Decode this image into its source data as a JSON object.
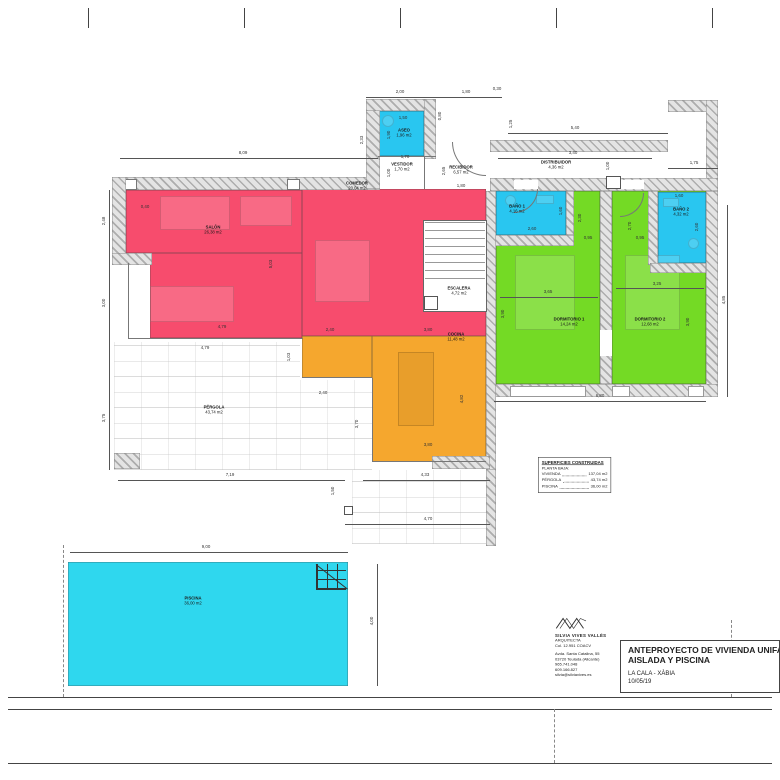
{
  "sheet": {
    "project": {
      "title_line1": "ANTEPROYECTO DE VIVIENDA UNIFAMILIAR",
      "title_line2": "AISLADA Y PISCINA",
      "location": "LA CALA - XÀBIA",
      "date": "10/05/19"
    },
    "architect": {
      "name": "SILVIA VIVES VALLÉS",
      "role": "ARQUITECTA",
      "license": "Col. 12.951 COACV",
      "address1": "Avda. Santa Catalina, 55",
      "address2": "03720 Teulada (Alicante)",
      "phone1": "965.741.048",
      "phone2": "609.166.827",
      "email": "silvia@silviavives.es"
    }
  },
  "legend": {
    "title": "SUPERFICIES CONSTRUIDAS",
    "subtitle": "PLANTA BAJA:",
    "rows": [
      {
        "label": "VIVIENDA",
        "value": "137,04 m2"
      },
      {
        "label": "PÉRGOLA",
        "value": "43,74 m2"
      },
      {
        "label": "PISCINA",
        "value": "36,00 m2"
      }
    ]
  },
  "rooms": [
    {
      "id": "salon",
      "name": "SALÓN",
      "area": "26,38 m2",
      "x": 213,
      "y": 230
    },
    {
      "id": "comedor",
      "name": "COMEDOR",
      "area": "20,04 m2",
      "x": 357,
      "y": 186
    },
    {
      "id": "cocina",
      "name": "COCINA",
      "area": "11,48 m2",
      "x": 456,
      "y": 337
    },
    {
      "id": "escalera",
      "name": "ESCALERA",
      "area": "4,72 m2",
      "x": 459,
      "y": 291
    },
    {
      "id": "recibidor",
      "name": "RECIBIDOR",
      "area": "6,57 m2",
      "x": 461,
      "y": 170
    },
    {
      "id": "vestidor",
      "name": "VESTIDOR",
      "area": "1,70 m2",
      "x": 402,
      "y": 167
    },
    {
      "id": "distribuidor",
      "name": "DISTRIBUIDOR",
      "area": "4,36 m2",
      "x": 556,
      "y": 165
    },
    {
      "id": "aseo",
      "name": "ASEO",
      "area": "1,96 m2",
      "x": 404,
      "y": 133
    },
    {
      "id": "bano1",
      "name": "BAÑO 1",
      "area": "4,16 m2",
      "x": 517,
      "y": 209
    },
    {
      "id": "bano2",
      "name": "BAÑO 2",
      "area": "4,32 m2",
      "x": 681,
      "y": 212
    },
    {
      "id": "dormitorio1",
      "name": "DORMITORIO 1",
      "area": "14,24 m2",
      "x": 569,
      "y": 322
    },
    {
      "id": "dormitorio2",
      "name": "DORMITORIO 2",
      "area": "12,68 m2",
      "x": 650,
      "y": 322
    },
    {
      "id": "pergola",
      "name": "PÉRGOLA",
      "area": "43,74 m2",
      "x": 214,
      "y": 410
    },
    {
      "id": "piscina",
      "name": "PISCINA",
      "area": "36,00 m2",
      "x": 193,
      "y": 601
    }
  ],
  "dimensions": [
    {
      "t": "8,09",
      "x": 243,
      "y": 153
    },
    {
      "t": "2,00",
      "x": 400,
      "y": 92
    },
    {
      "t": "1,80",
      "x": 466,
      "y": 92
    },
    {
      "t": "0,30",
      "x": 497,
      "y": 89
    },
    {
      "t": "5,40",
      "x": 575,
      "y": 128
    },
    {
      "t": "3,40",
      "x": 573,
      "y": 153
    },
    {
      "t": "1,75",
      "x": 694,
      "y": 163
    },
    {
      "t": "1,00",
      "x": 608,
      "y": 166,
      "v": 1
    },
    {
      "t": "1,25",
      "x": 511,
      "y": 124,
      "v": 1
    },
    {
      "t": "2,33",
      "x": 362,
      "y": 140,
      "v": 1
    },
    {
      "t": "1,90",
      "x": 389,
      "y": 135,
      "v": 1
    },
    {
      "t": "1,50",
      "x": 403,
      "y": 118
    },
    {
      "t": "0,80",
      "x": 440,
      "y": 116,
      "v": 1
    },
    {
      "t": "1,70",
      "x": 405,
      "y": 157
    },
    {
      "t": "1,00",
      "x": 389,
      "y": 173,
      "v": 1
    },
    {
      "t": "2,65",
      "x": 444,
      "y": 171,
      "v": 1
    },
    {
      "t": "1,80",
      "x": 461,
      "y": 186
    },
    {
      "t": "2,48",
      "x": 104,
      "y": 221,
      "v": 1
    },
    {
      "t": "3,00",
      "x": 104,
      "y": 303,
      "v": 1
    },
    {
      "t": "3,75",
      "x": 104,
      "y": 418,
      "v": 1
    },
    {
      "t": "0,40",
      "x": 145,
      "y": 207
    },
    {
      "t": "5,03",
      "x": 271,
      "y": 264,
      "v": 1
    },
    {
      "t": "4,79",
      "x": 222,
      "y": 327
    },
    {
      "t": "4,79",
      "x": 205,
      "y": 348
    },
    {
      "t": "2,40",
      "x": 330,
      "y": 330
    },
    {
      "t": "3,80",
      "x": 428,
      "y": 330
    },
    {
      "t": "1,03",
      "x": 289,
      "y": 357,
      "v": 1
    },
    {
      "t": "2,40",
      "x": 323,
      "y": 393
    },
    {
      "t": "3,70",
      "x": 357,
      "y": 424,
      "v": 1
    },
    {
      "t": "4,82",
      "x": 462,
      "y": 399,
      "v": 1
    },
    {
      "t": "3,80",
      "x": 428,
      "y": 445
    },
    {
      "t": "7,19",
      "x": 230,
      "y": 475
    },
    {
      "t": "4,33",
      "x": 425,
      "y": 475
    },
    {
      "t": "1,50",
      "x": 333,
      "y": 491,
      "v": 1
    },
    {
      "t": "4,70",
      "x": 428,
      "y": 519
    },
    {
      "t": "6,80",
      "x": 600,
      "y": 396
    },
    {
      "t": "3,65",
      "x": 548,
      "y": 292
    },
    {
      "t": "3,25",
      "x": 657,
      "y": 284
    },
    {
      "t": "3,90",
      "x": 503,
      "y": 314,
      "v": 1
    },
    {
      "t": "3,90",
      "x": 688,
      "y": 322,
      "v": 1
    },
    {
      "t": "4,85",
      "x": 724,
      "y": 300,
      "v": 1
    },
    {
      "t": "2,30",
      "x": 580,
      "y": 218,
      "v": 1
    },
    {
      "t": "2,70",
      "x": 630,
      "y": 226,
      "v": 1
    },
    {
      "t": "1,60",
      "x": 561,
      "y": 211,
      "v": 1
    },
    {
      "t": "2,60",
      "x": 532,
      "y": 229
    },
    {
      "t": "1,60",
      "x": 679,
      "y": 196
    },
    {
      "t": "2,60",
      "x": 697,
      "y": 227,
      "v": 1
    },
    {
      "t": "0,95",
      "x": 588,
      "y": 238
    },
    {
      "t": "0,95",
      "x": 640,
      "y": 238
    },
    {
      "t": "9,00",
      "x": 206,
      "y": 547
    },
    {
      "t": "4,00",
      "x": 372,
      "y": 621,
      "v": 1
    }
  ],
  "colors": {
    "salon": "#f74c6d",
    "cocina": "#f5a72e",
    "dormitorio": "#74da25",
    "bano": "#29c6f0",
    "piscina": "#2fd7ee"
  }
}
